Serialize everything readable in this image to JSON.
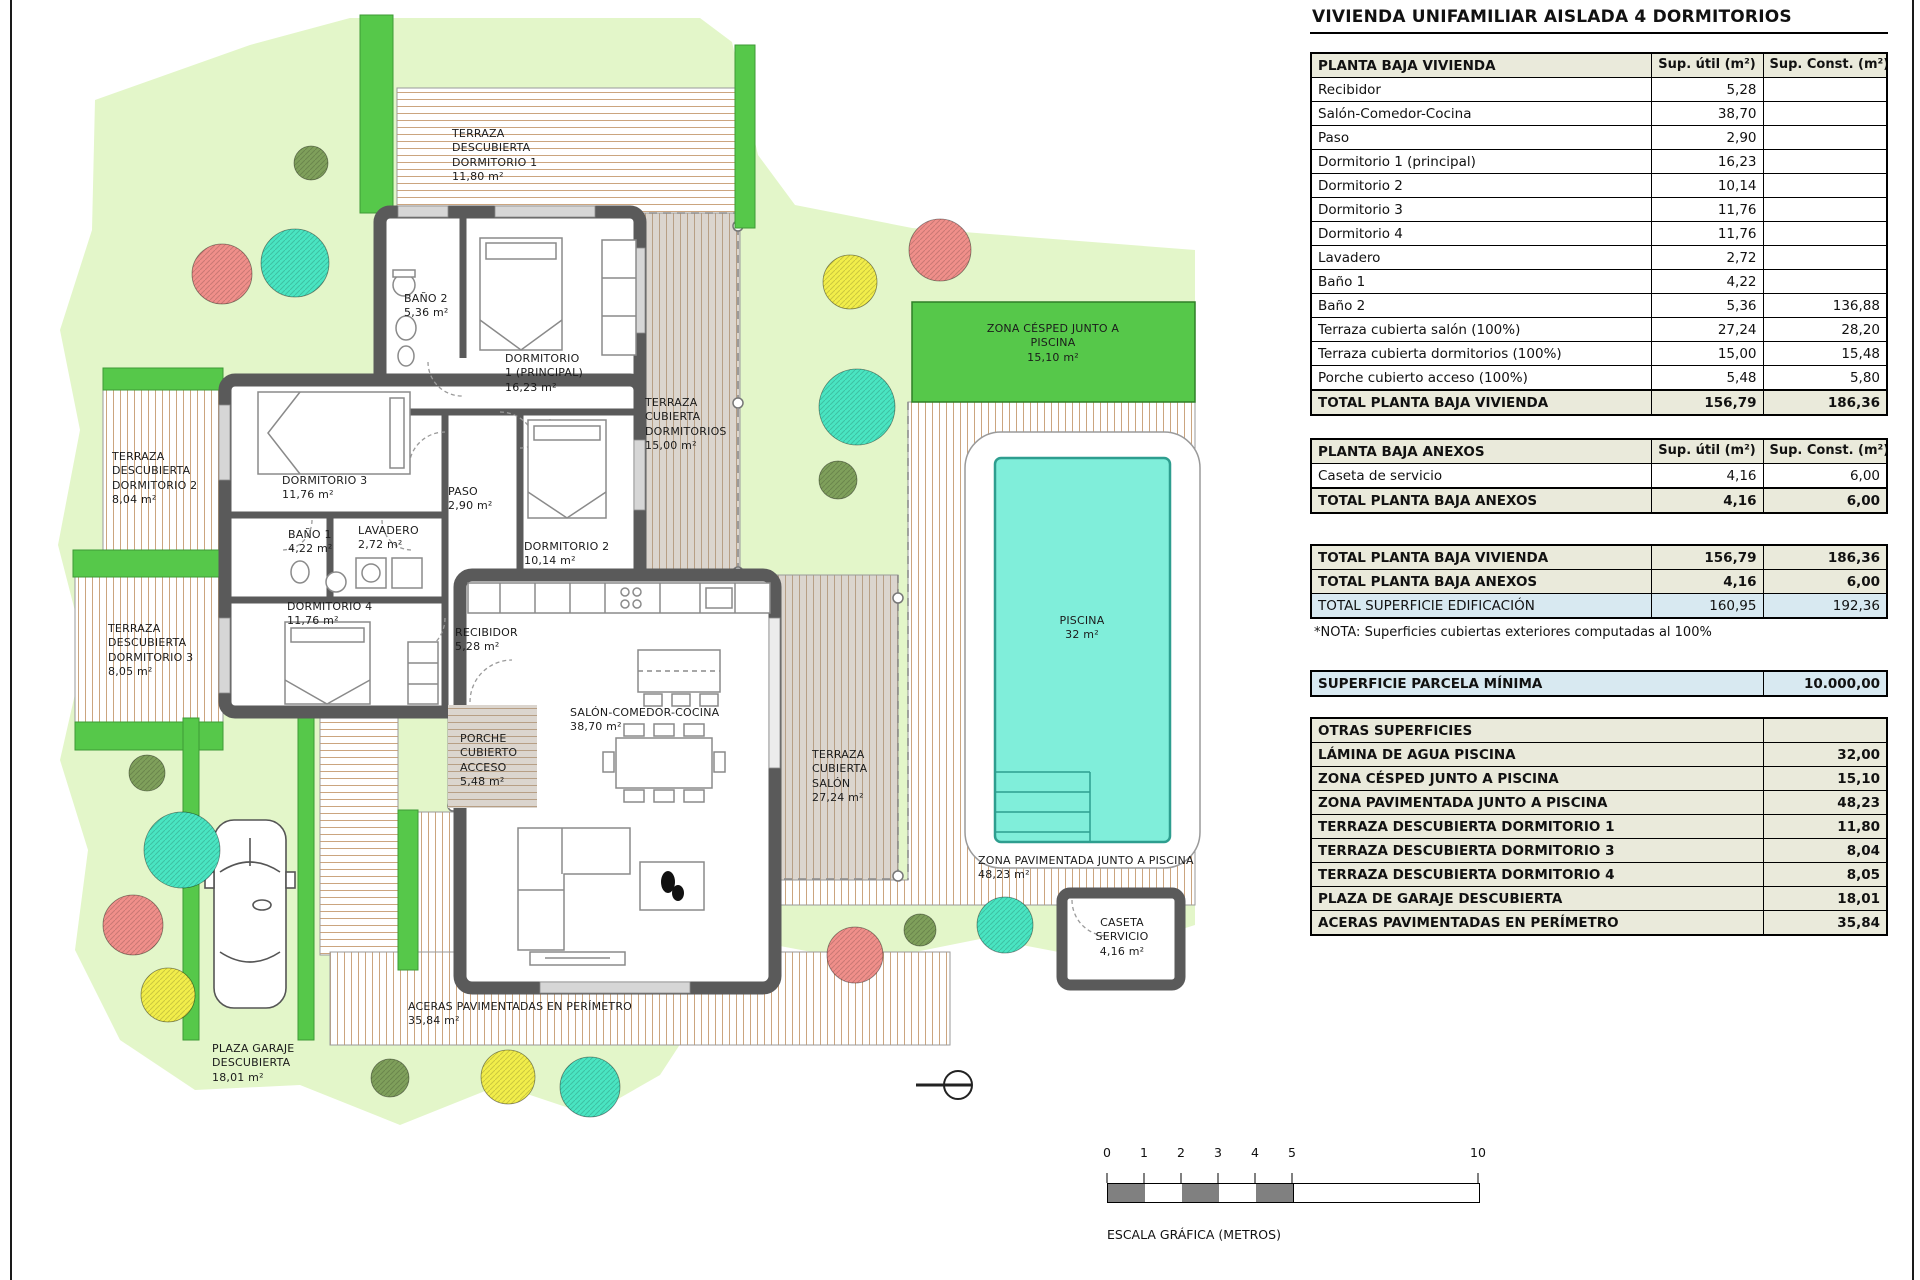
{
  "title": "VIVIENDA UNIFAMILIAR AISLADA 4 DORMITORIOS",
  "columns": {
    "util": "Sup. útil\n(m²)",
    "const": "Sup. Const.\n(m²)"
  },
  "t1": {
    "header": "PLANTA BAJA VIVIENDA",
    "rows": [
      [
        "Recibidor",
        "5,28",
        ""
      ],
      [
        "Salón-Comedor-Cocina",
        "38,70",
        ""
      ],
      [
        "Paso",
        "2,90",
        ""
      ],
      [
        "Dormitorio 1 (principal)",
        "16,23",
        ""
      ],
      [
        "Dormitorio 2",
        "10,14",
        ""
      ],
      [
        "Dormitorio 3",
        "11,76",
        ""
      ],
      [
        "Dormitorio 4",
        "11,76",
        ""
      ],
      [
        "Lavadero",
        "2,72",
        ""
      ],
      [
        "Baño 1",
        "4,22",
        ""
      ],
      [
        "Baño 2",
        "5,36",
        "136,88"
      ],
      [
        "Terraza cubierta salón (100%)",
        "27,24",
        "28,20"
      ],
      [
        "Terraza cubierta dormitorios (100%)",
        "15,00",
        "15,48"
      ],
      [
        "Porche cubierto acceso (100%)",
        "5,48",
        "5,80"
      ]
    ],
    "total": [
      "TOTAL PLANTA BAJA VIVIENDA",
      "156,79",
      "186,36"
    ]
  },
  "t2": {
    "header": "PLANTA BAJA ANEXOS",
    "rows": [
      [
        "Caseta de servicio",
        "4,16",
        "6,00"
      ]
    ],
    "total": [
      "TOTAL PLANTA BAJA ANEXOS",
      "4,16",
      "6,00"
    ]
  },
  "t3": {
    "rows": [
      [
        "TOTAL PLANTA BAJA VIVIENDA",
        "156,79",
        "186,36",
        "beige"
      ],
      [
        "TOTAL PLANTA BAJA ANEXOS",
        "4,16",
        "6,00",
        "beige"
      ],
      [
        "TOTAL SUPERFICIE EDIFICACIÓN",
        "160,95",
        "192,36",
        "blue"
      ]
    ]
  },
  "nota": "*NOTA: Superficies cubiertas exteriores computadas al 100%",
  "parcela": {
    "label": "SUPERFICIE PARCELA MÍNIMA",
    "value": "10.000,00"
  },
  "otras": {
    "header": "OTRAS SUPERFICIES",
    "rows": [
      [
        "LÁMINA DE AGUA PISCINA",
        "32,00"
      ],
      [
        "ZONA CÉSPED JUNTO A PISCINA",
        "15,10"
      ],
      [
        "ZONA PAVIMENTADA JUNTO A PISCINA",
        "48,23"
      ],
      [
        "TERRAZA DESCUBIERTA DORMITORIO 1",
        "11,80"
      ],
      [
        "TERRAZA DESCUBIERTA DORMITORIO 3",
        "8,04"
      ],
      [
        "TERRAZA DESCUBIERTA DORMITORIO 4",
        "8,05"
      ],
      [
        "PLAZA DE GARAJE DESCUBIERTA",
        "18,01"
      ],
      [
        "ACERAS PAVIMENTADAS EN PERÍMETRO",
        "35,84"
      ]
    ]
  },
  "scale": {
    "ticks": [
      "0",
      "1",
      "2",
      "3",
      "4",
      "5",
      "10"
    ],
    "caption": "ESCALA GRÁFICA (METROS)"
  },
  "colors": {
    "lawn": "#E3F6C9",
    "hedge": "#56C84A",
    "pool_water": "#80EEDA",
    "pool_edge": "#2E9E8F",
    "wall": "#5A5A5A",
    "stripe": "#CBA57F",
    "deck_gray": "#DBD5CE",
    "tree_salmon": "#F08F8A",
    "tree_teal": "#49E5C2",
    "tree_yellow": "#F2EE4A",
    "tree_olive": "#7FA05B",
    "table_beige": "#EAEADB",
    "table_blue": "#D8E9F1"
  },
  "plan": {
    "labels": [
      {
        "id": "label-terraza-dorm1",
        "x": 452,
        "y": 127,
        "align": "left",
        "lines": "TERRAZA\nDESCUBIERTA\nDORMITORIO 1\n11,80 m²"
      },
      {
        "id": "label-bano2",
        "x": 404,
        "y": 292,
        "align": "left",
        "lines": "BAÑO 2\n5,36 m²"
      },
      {
        "id": "label-dorm1",
        "x": 505,
        "y": 352,
        "align": "left",
        "lines": "DORMITORIO\n1 (PRINCIPAL)\n16,23 m²"
      },
      {
        "id": "label-terraza-cub-dorms",
        "x": 645,
        "y": 396,
        "align": "left",
        "lines": "TERRAZA\nCUBIERTA\nDORMITORIOS\n15,00 m²"
      },
      {
        "id": "label-terraza-dorm2",
        "x": 112,
        "y": 450,
        "align": "left",
        "lines": "TERRAZA\nDESCUBIERTA\nDORMITORIO 2\n8,04 m²"
      },
      {
        "id": "label-dorm3",
        "x": 282,
        "y": 474,
        "align": "left",
        "lines": "DORMITORIO 3\n11,76 m²"
      },
      {
        "id": "label-paso",
        "x": 448,
        "y": 485,
        "align": "left",
        "lines": "PASO\n2,90 m²"
      },
      {
        "id": "label-bano1",
        "x": 288,
        "y": 528,
        "align": "left",
        "lines": "BAÑO 1\n4,22 m²"
      },
      {
        "id": "label-lavadero",
        "x": 358,
        "y": 524,
        "align": "left",
        "lines": "LAVADERO\n2,72 m²"
      },
      {
        "id": "label-dorm2",
        "x": 524,
        "y": 540,
        "align": "left",
        "lines": "DORMITORIO 2\n10,14 m²"
      },
      {
        "id": "label-terraza-dorm3",
        "x": 108,
        "y": 622,
        "align": "left",
        "lines": "TERRAZA\nDESCUBIERTA\nDORMITORIO 3\n8,05 m²"
      },
      {
        "id": "label-dorm4",
        "x": 287,
        "y": 600,
        "align": "left",
        "lines": "DORMITORIO 4\n11,76 m²"
      },
      {
        "id": "label-recibidor",
        "x": 455,
        "y": 626,
        "align": "left",
        "lines": "RECIBIDOR\n5,28 m²"
      },
      {
        "id": "label-zona-cesped",
        "x": 1053,
        "y": 322,
        "align": "center",
        "lines": "ZONA CÉSPED JUNTO A PISCINA\n15,10 m²"
      },
      {
        "id": "label-salon",
        "x": 570,
        "y": 706,
        "align": "left",
        "lines": "SALÓN-COMEDOR-COCINA\n38,70 m²"
      },
      {
        "id": "label-porche",
        "x": 460,
        "y": 732,
        "align": "left",
        "lines": "PORCHE\nCUBIERTO\nACCESO\n5,48 m²"
      },
      {
        "id": "label-terraza-salon",
        "x": 812,
        "y": 748,
        "align": "left",
        "lines": "TERRAZA\nCUBIERTA\nSALÓN\n27,24 m²"
      },
      {
        "id": "label-piscina",
        "x": 1082,
        "y": 614,
        "align": "center",
        "lines": "PISCINA\n32 m²"
      },
      {
        "id": "label-zona-pavimentada",
        "x": 978,
        "y": 854,
        "align": "left",
        "lines": "ZONA PAVIMENTADA JUNTO A PISCINA\n48,23 m²"
      },
      {
        "id": "label-caseta",
        "x": 1122,
        "y": 916,
        "align": "center",
        "lines": "CASETA\nSERVICIO\n4,16 m²"
      },
      {
        "id": "label-aceras",
        "x": 408,
        "y": 1000,
        "align": "left",
        "lines": "ACERAS PAVIMENTADAS EN PERÍMETRO\n35,84 m²"
      },
      {
        "id": "label-plaza-garaje",
        "x": 212,
        "y": 1042,
        "align": "left",
        "lines": "PLAZA GARAJE\nDESCUBIERTA\n18,01 m²"
      }
    ]
  }
}
